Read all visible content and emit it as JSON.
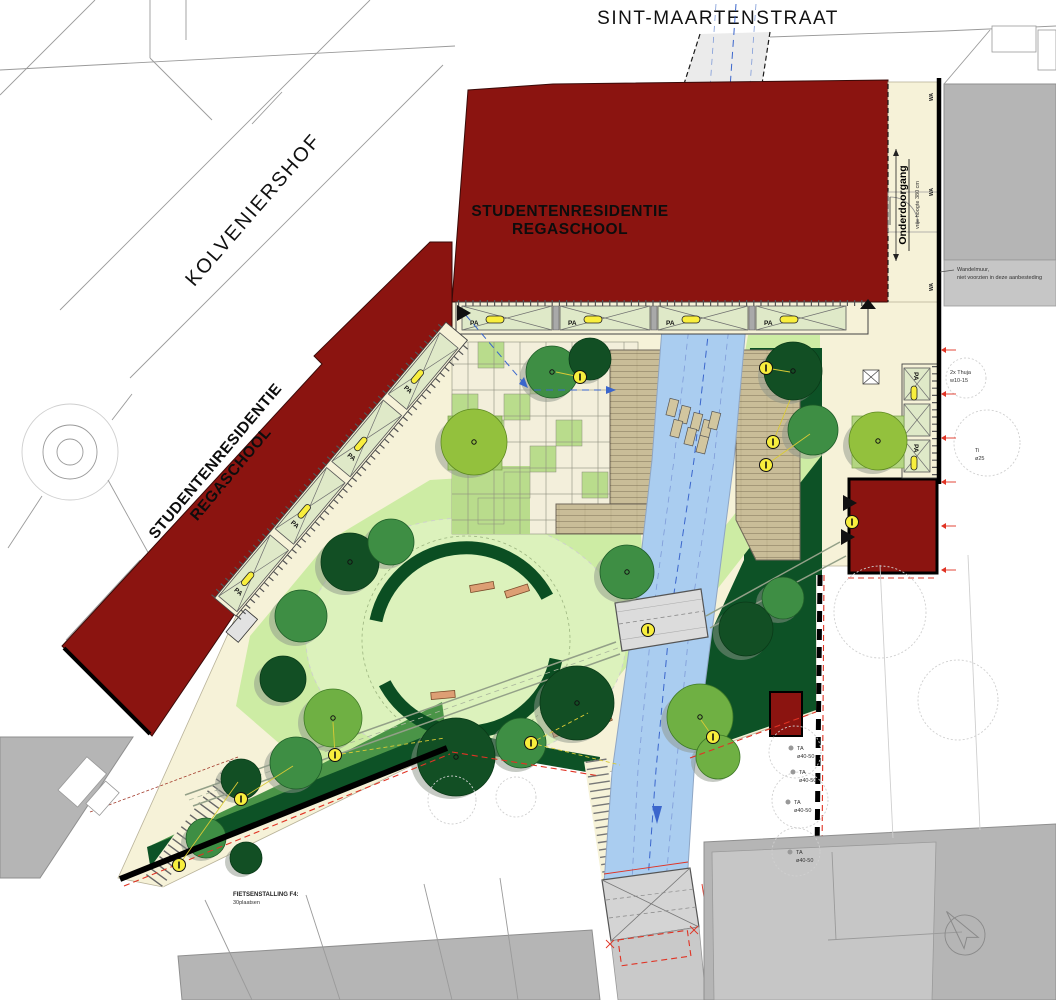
{
  "streets": {
    "top": "SINT-MAARTENSTRAAT",
    "left": "KOLVENIERSHOF"
  },
  "buildings": {
    "residence_line1": "STUDENTENRESIDENTIE",
    "residence_line2": "REGASCHOOL"
  },
  "passage": {
    "label": "Onderdoorgang",
    "sublabel": "vrije hoogte 380 cm",
    "wa": "WA"
  },
  "parking": {
    "pa": "PA"
  },
  "notes": {
    "wall_line1": "Wandelmuur,",
    "wall_line2": "niet voorzien in deze aanbesteding",
    "bike_line1": "FIETSENSTALLING F4:",
    "bike_line2": "30plaatsen"
  },
  "existing_trees": {
    "thuja_line1": "2x Thuja",
    "thuja_line2": "w10-15",
    "ti_line1": "Ti",
    "ti_line2": "ø25",
    "ta": "TA",
    "ta_size": "ø40-50"
  },
  "colors": {
    "building_red": "#8b1410",
    "under_channel": "#a6564c",
    "water_blue": "#aacdf0",
    "water_line": "#3b66cc",
    "path_cream": "#f6f2d8",
    "parking_green": "#dfe9c8",
    "lawn_green": "#cdeca4",
    "lawn_light": "#dcf2bc",
    "tile_green": "#b9dc8c",
    "hedge_dark": "#0b4e22",
    "strip_dark": "#0d5226",
    "grass_mid": "#4a9447",
    "deck_tan": "#c9bd98",
    "bench_tan": "#dd9f74",
    "marker_yellow": "#f8ee3d",
    "boundary_red": "#e03324",
    "gray_block": "#b5b5b5"
  }
}
